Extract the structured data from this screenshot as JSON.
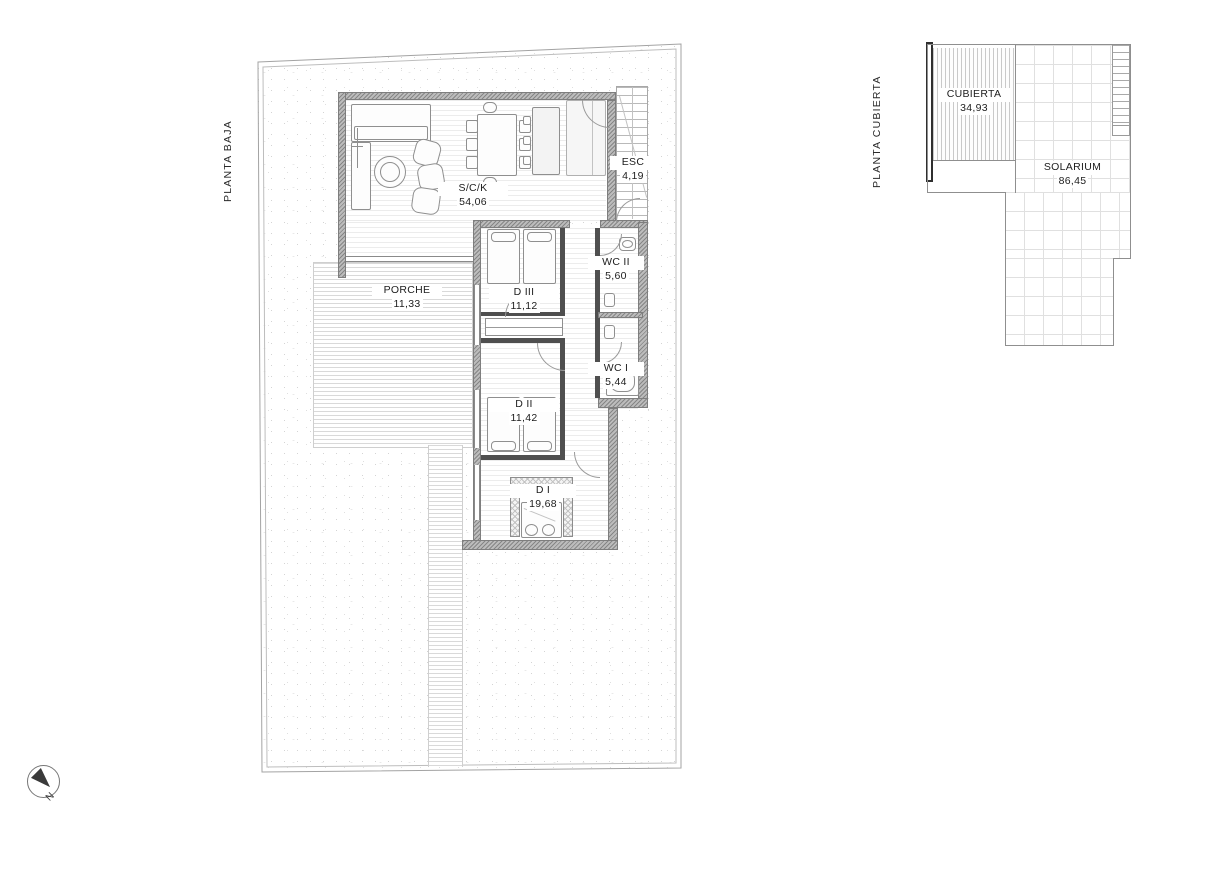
{
  "sheet": {
    "compass_label": "N"
  },
  "plans": {
    "planta_baja": {
      "title": "PLANTA BAJA",
      "rooms": [
        {
          "id": "sck",
          "name": "S/C/K",
          "area": "54,06"
        },
        {
          "id": "esc",
          "name": "ESC",
          "area": "4,19"
        },
        {
          "id": "wc2",
          "name": "WC II",
          "area": "5,60"
        },
        {
          "id": "wc1",
          "name": "WC I",
          "area": "5,44"
        },
        {
          "id": "d3",
          "name": "D III",
          "area": "11,12"
        },
        {
          "id": "d2",
          "name": "D II",
          "area": "11,42"
        },
        {
          "id": "d1",
          "name": "D I",
          "area": "19,68"
        },
        {
          "id": "porche",
          "name": "PORCHE",
          "area": "11,33"
        }
      ]
    },
    "planta_cubierta": {
      "title": "PLANTA CUBIERTA",
      "rooms": [
        {
          "id": "cubierta",
          "name": "CUBIERTA",
          "area": "34,93"
        },
        {
          "id": "solarium",
          "name": "SOLARIUM",
          "area": "86,45"
        }
      ]
    }
  },
  "colors": {
    "wall_fill": "#bcbcbc",
    "partition": "#4f4f4f",
    "line": "#8f8f8f",
    "text": "#1d1d1d",
    "needle": "#3a3a3a"
  }
}
